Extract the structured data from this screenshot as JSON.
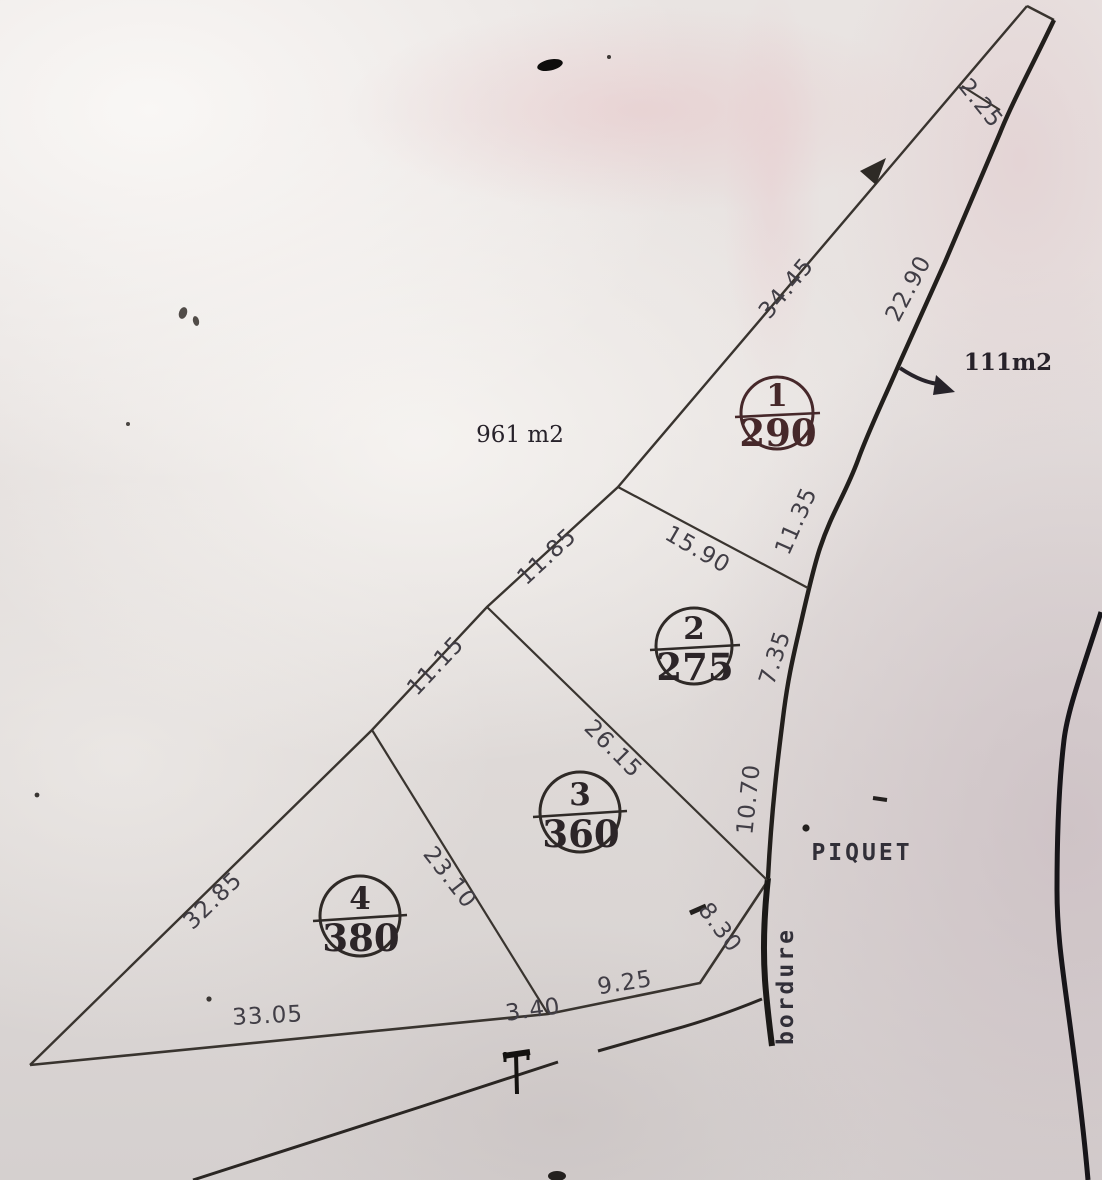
{
  "plan": {
    "total_area": "961 m2",
    "sliver_area": "111m2",
    "piquet": "PIQUET",
    "bordure": "bordure",
    "lots": [
      {
        "number": "1",
        "area": "290"
      },
      {
        "number": "2",
        "area": "275"
      },
      {
        "number": "3",
        "area": "360"
      },
      {
        "number": "4",
        "area": "380"
      }
    ],
    "dimensions": {
      "tip": "2.25",
      "left_top": "34.45",
      "road_top": "22.90",
      "road_upper_mid": "11.35",
      "lot12_divider": "15.90",
      "left_upper_mid": "11.85",
      "road_lower_mid": "7.35",
      "left_lower_mid": "11.15",
      "lot23_divider": "26.15",
      "road_bottom": "10.70",
      "lot34_divider": "23.10",
      "left_bottom": "32.85",
      "bottom_right": "8.30",
      "bottom_mid": "9.25",
      "bottom_small": "3.40",
      "bottom_left": "33.05"
    }
  },
  "colors": {
    "ink": "#2e2a28",
    "ink_thick": "#1c1a18",
    "paper": "#e6e1df",
    "dim_text": "#413e46"
  }
}
